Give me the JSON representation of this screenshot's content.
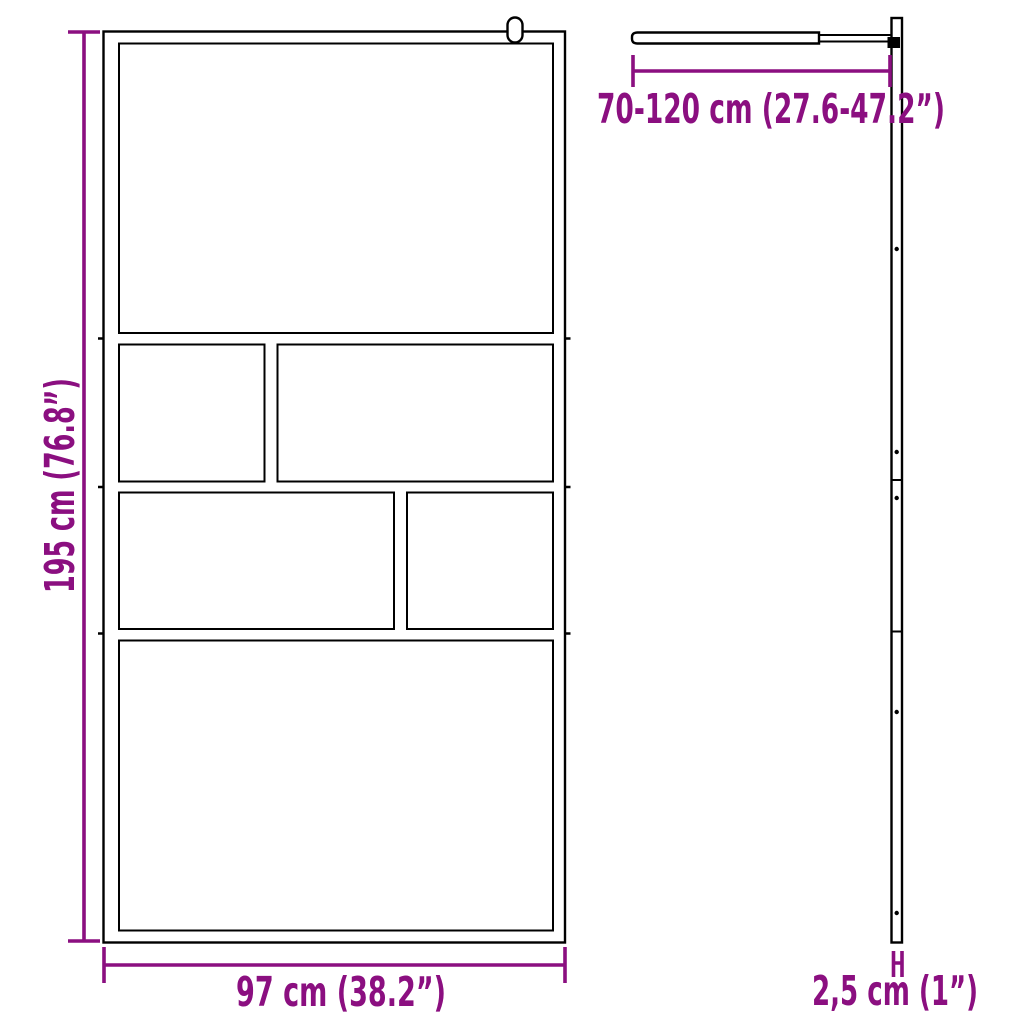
{
  "colors": {
    "accent": "#8b0f80",
    "line": "#000000",
    "background": "#ffffff"
  },
  "dimensions": {
    "height": {
      "label": "195 cm (76.8”)"
    },
    "width": {
      "label": "97 cm (38.2”)"
    },
    "arm_length": {
      "label": "70-120 cm (27.6-47.2”)"
    },
    "thickness": {
      "label": "2,5 cm (1”)"
    }
  }
}
